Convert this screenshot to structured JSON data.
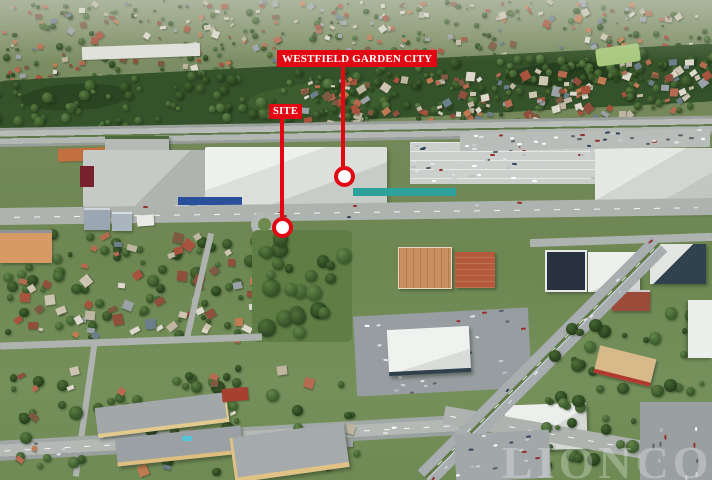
{
  "callouts": {
    "accent_color": "#e30613",
    "text_color": "#ffffff",
    "westfield": {
      "label": "WESTFIELD GARDEN CITY"
    },
    "site": {
      "label": "SITE"
    }
  },
  "watermark": {
    "text": "LIONCORP"
  }
}
